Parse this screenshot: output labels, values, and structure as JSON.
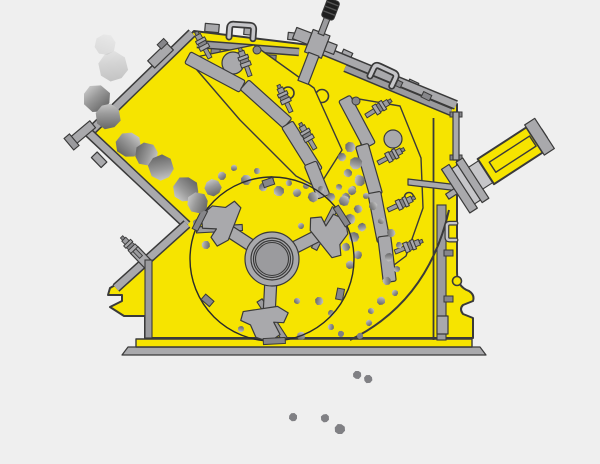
{
  "diagram": {
    "label": "impact-crusher-cutaway-illustration",
    "width": 600,
    "height": 464,
    "colors": {
      "background": "#efefef",
      "body_yellow": "#f6e400",
      "outline": "#3a3a3a",
      "metal": "#a9a9ac",
      "metal_mid": "#9b9b9e",
      "metal_dark": "#86868a",
      "metal_light": "#c6c6c9",
      "knob_dark": "#1f1f1f",
      "knob_rib": "#555555",
      "rock_light": "#d6d6d6",
      "rock_mid": "#9a9a9a",
      "rock_dark": "#5f5f5f",
      "particle": "#808084",
      "rotor_line": "#2a2a2a"
    }
  },
  "rocks": {
    "faded": [
      [
        113,
        67,
        14,
        35,
        0.32
      ],
      [
        105,
        45,
        10,
        60,
        0.15
      ]
    ],
    "feed": [
      [
        97,
        99,
        13,
        0
      ],
      [
        108,
        117,
        12,
        40
      ],
      [
        128,
        145,
        12,
        85
      ],
      [
        146,
        154,
        11,
        150
      ],
      [
        161,
        167,
        12,
        210
      ],
      [
        186,
        189,
        12,
        265
      ],
      [
        198,
        203,
        10,
        330
      ],
      [
        213,
        188,
        8,
        20
      ]
    ],
    "particles": [
      [
        222,
        176,
        4,
        0
      ],
      [
        234,
        168,
        3,
        45
      ],
      [
        246,
        180,
        5,
        90
      ],
      [
        257,
        171,
        3,
        135
      ],
      [
        263,
        187,
        4,
        180
      ],
      [
        271,
        179,
        3,
        225
      ],
      [
        279,
        191,
        5,
        270
      ],
      [
        289,
        183,
        3,
        315
      ],
      [
        297,
        193,
        4,
        20
      ],
      [
        306,
        186,
        3,
        65
      ],
      [
        313,
        197,
        5,
        110
      ],
      [
        321,
        189,
        3,
        155
      ],
      [
        331,
        197,
        4,
        200
      ],
      [
        339,
        187,
        3,
        245
      ],
      [
        346,
        197,
        4,
        290
      ],
      [
        353,
        189,
        3,
        335
      ],
      [
        359,
        179,
        4,
        10
      ],
      [
        366,
        196,
        3,
        55
      ],
      [
        373,
        206,
        4,
        100
      ],
      [
        350,
        147,
        5,
        145
      ],
      [
        342,
        157,
        4,
        190
      ],
      [
        356,
        163,
        6,
        235
      ],
      [
        348,
        173,
        4,
        280
      ],
      [
        360,
        181,
        5,
        325
      ],
      [
        352,
        191,
        4,
        30
      ],
      [
        344,
        201,
        5,
        75
      ],
      [
        358,
        209,
        4,
        120
      ],
      [
        350,
        219,
        5,
        165
      ],
      [
        362,
        227,
        4,
        210
      ],
      [
        354,
        237,
        5,
        255
      ],
      [
        346,
        247,
        4,
        300
      ],
      [
        358,
        255,
        4,
        345
      ],
      [
        350,
        265,
        4,
        40
      ],
      [
        381,
        221,
        3,
        85
      ],
      [
        391,
        233,
        4,
        130
      ],
      [
        399,
        245,
        3,
        175
      ],
      [
        389,
        257,
        4,
        220
      ],
      [
        397,
        269,
        3,
        265
      ],
      [
        387,
        281,
        4,
        310
      ],
      [
        395,
        293,
        3,
        355
      ],
      [
        381,
        301,
        4,
        50
      ],
      [
        371,
        311,
        3,
        95
      ],
      [
        201,
        199,
        5,
        140
      ],
      [
        209,
        211,
        4,
        185
      ],
      [
        197,
        223,
        4,
        230
      ],
      [
        215,
        233,
        3,
        275
      ],
      [
        206,
        245,
        4,
        320
      ],
      [
        301,
        226,
        3,
        5
      ],
      [
        311,
        241,
        3,
        50
      ],
      [
        297,
        301,
        3,
        95
      ],
      [
        319,
        301,
        4,
        140
      ],
      [
        331,
        313,
        3,
        185
      ],
      [
        241,
        329,
        3,
        230
      ],
      [
        281,
        333,
        3,
        275
      ],
      [
        331,
        327,
        3,
        320
      ],
      [
        369,
        323,
        3,
        15
      ],
      [
        301,
        336,
        4,
        60
      ]
    ],
    "discharge": [
      [
        341,
        334,
        3,
        0
      ],
      [
        360,
        336,
        3,
        45
      ],
      [
        357,
        375,
        4,
        90
      ],
      [
        368,
        379,
        4,
        135
      ],
      [
        293,
        417,
        4,
        180
      ],
      [
        325,
        418,
        4,
        225
      ],
      [
        340,
        429,
        5,
        270
      ]
    ]
  }
}
